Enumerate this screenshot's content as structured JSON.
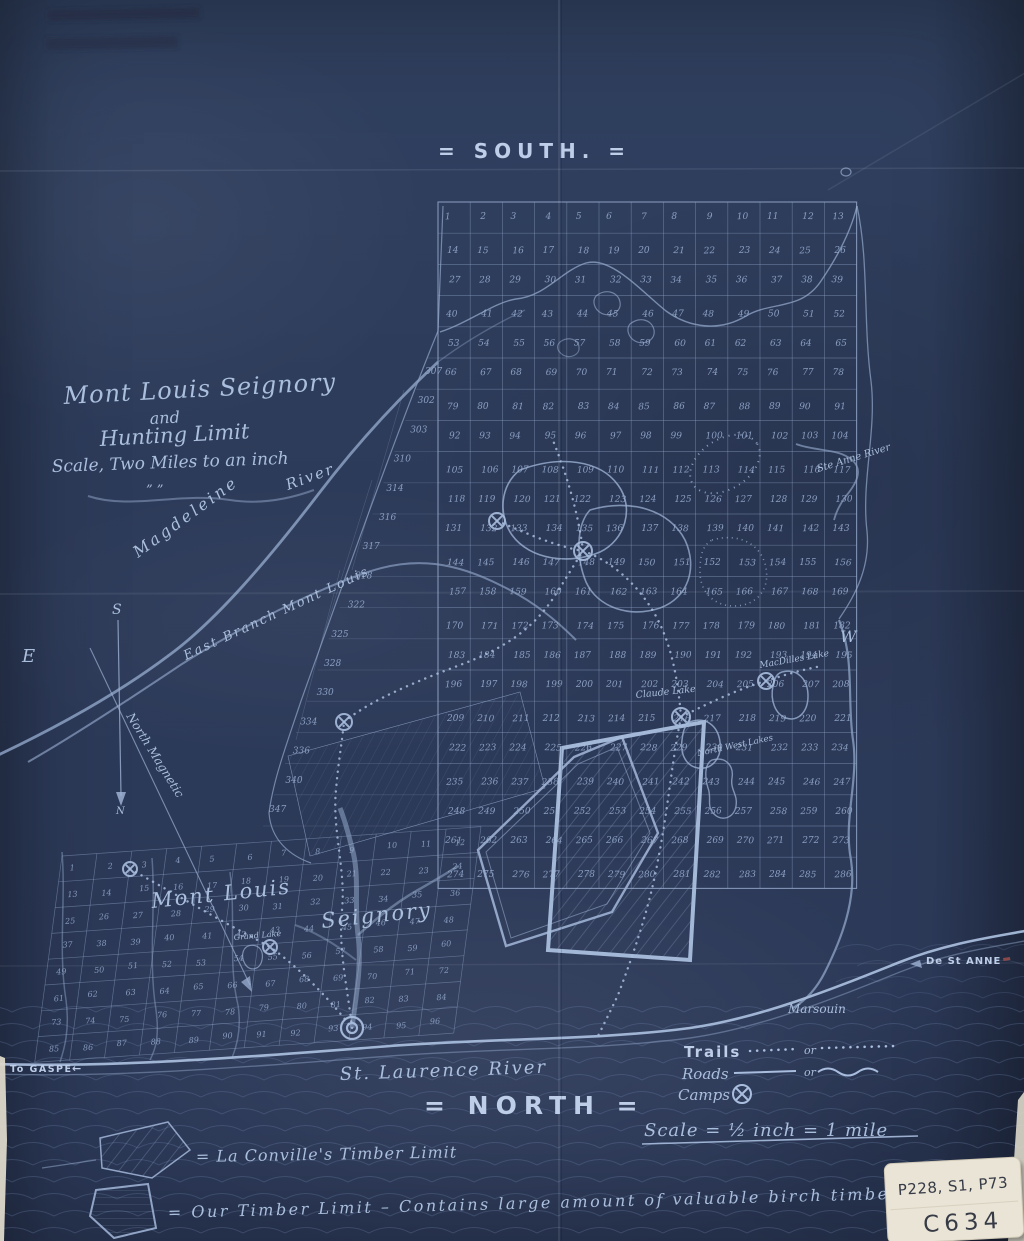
{
  "colors": {
    "paper": "#2d3b5a",
    "ink": "#9db1d3",
    "ink_bright": "#c2d1ea",
    "label_paper": "#eae4d6",
    "label_ink": "#363b46"
  },
  "orientation": {
    "top": "= SOUTH. =",
    "bottom": "= NORTH =",
    "east": "E",
    "west": "W",
    "compass_s": "S",
    "compass_n": "N",
    "magnetic_label": "North Magnetic"
  },
  "title_block": {
    "title_line1": "Mont Louis Seignory",
    "title_line2": "and",
    "title_line3": "Hunting Limit",
    "scale_note": "Scale, Two Miles to an inch",
    "ditto": "” ”"
  },
  "main_grid": {
    "columns": 13,
    "rows": 22,
    "first_lot": 1,
    "west_edge_lots": [
      "307",
      "302",
      "303",
      "310",
      "314",
      "316",
      "317",
      "318",
      "322",
      "325",
      "328",
      "330",
      "334",
      "336",
      "340",
      "347"
    ]
  },
  "seignory_grid": {
    "columns": 12,
    "rows": 8,
    "first_lot": 1,
    "label_west": "Mont Louis",
    "label_east": "Seignory"
  },
  "features": {
    "st_laurence_river": "St. Laurence River",
    "magdeleine_1": "Magdeleine",
    "magdeleine_2": "River",
    "east_branch": "East Branch Mont Louis",
    "ste_anne_river": "Ste Anne River",
    "marsouin": "Marsouin",
    "claude_lake": "Claude Lake",
    "macdilles_lake": "MacDilles Lake",
    "north_west_lakes": "North West Lakes",
    "grand_lake": "Grand Lake",
    "to_gaspe": "To GASPE",
    "to_gaspe_arrow": "←",
    "de_st_anne": "De St ANNE"
  },
  "legend": {
    "trails_label": "Trails",
    "roads_label": "Roads",
    "camps_label": "Camps",
    "or_1": "or",
    "or_2": "or",
    "scale_label": "Scale = ½ inch = 1 mile"
  },
  "notes": {
    "couville_note": "= La Conville's Timber Limit",
    "our_limit_note": "= Our Timber Limit – Contains large amount of valuable birch timber"
  },
  "catalog_label": {
    "line1": "P228, S1, P73",
    "line2": "C634"
  }
}
